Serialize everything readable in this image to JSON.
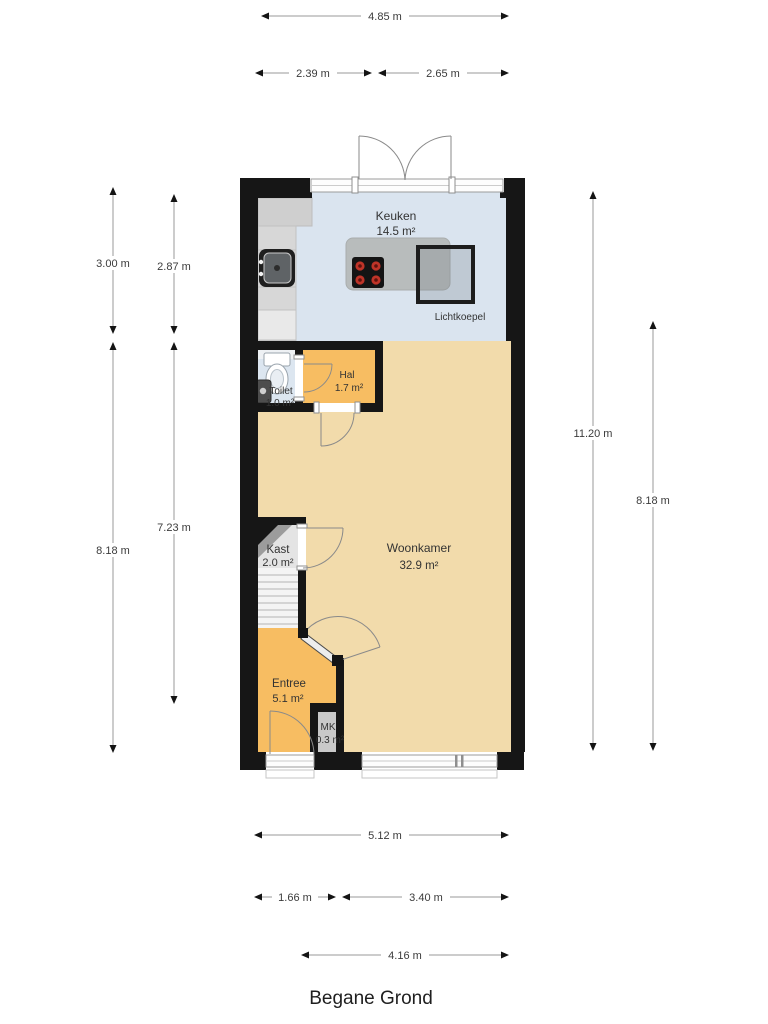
{
  "title": "Begane Grond",
  "rooms": {
    "keuken": {
      "name": "Keuken",
      "area": "14.5 m²"
    },
    "toilet": {
      "name": "Toilet",
      "area": "1.0 m²"
    },
    "hal": {
      "name": "Hal",
      "area": "1.7 m²"
    },
    "kast": {
      "name": "Kast",
      "area": "2.0 m²"
    },
    "woonkamer": {
      "name": "Woonkamer",
      "area": "32.9 m²"
    },
    "entree": {
      "name": "Entree",
      "area": "5.1 m²"
    },
    "mk": {
      "name": "MK",
      "area": "0.3 m²"
    }
  },
  "annotations": {
    "lichtkoepel": "Lichtkoepel"
  },
  "dimensions": {
    "top": {
      "total": "4.85 m",
      "left_segment": "2.39 m",
      "right_segment": "2.65 m"
    },
    "left": {
      "outer_top": "3.00 m",
      "inner_top": "2.87 m",
      "inner_bottom": "7.23 m",
      "outer_bottom": "8.18 m"
    },
    "right": {
      "full_height": "11.20 m",
      "lower": "8.18 m"
    },
    "bottom": {
      "total": "5.12 m",
      "left_segment": "1.66 m",
      "right_segment": "3.40 m",
      "offset_total": "4.16 m"
    }
  },
  "colors": {
    "wall": "#161616",
    "kitchen_floor": "#dae4ef",
    "living_floor": "#f2dbab",
    "hall_floor": "#f7bd62",
    "closet_floor": "#e4e4e4",
    "stairs": "#f4f4f4",
    "meter_cupboard_floor": "#c9c9c9",
    "counter": "#d7d7d7",
    "island": "#b8bcbc",
    "burner_red": "#bf3428"
  }
}
